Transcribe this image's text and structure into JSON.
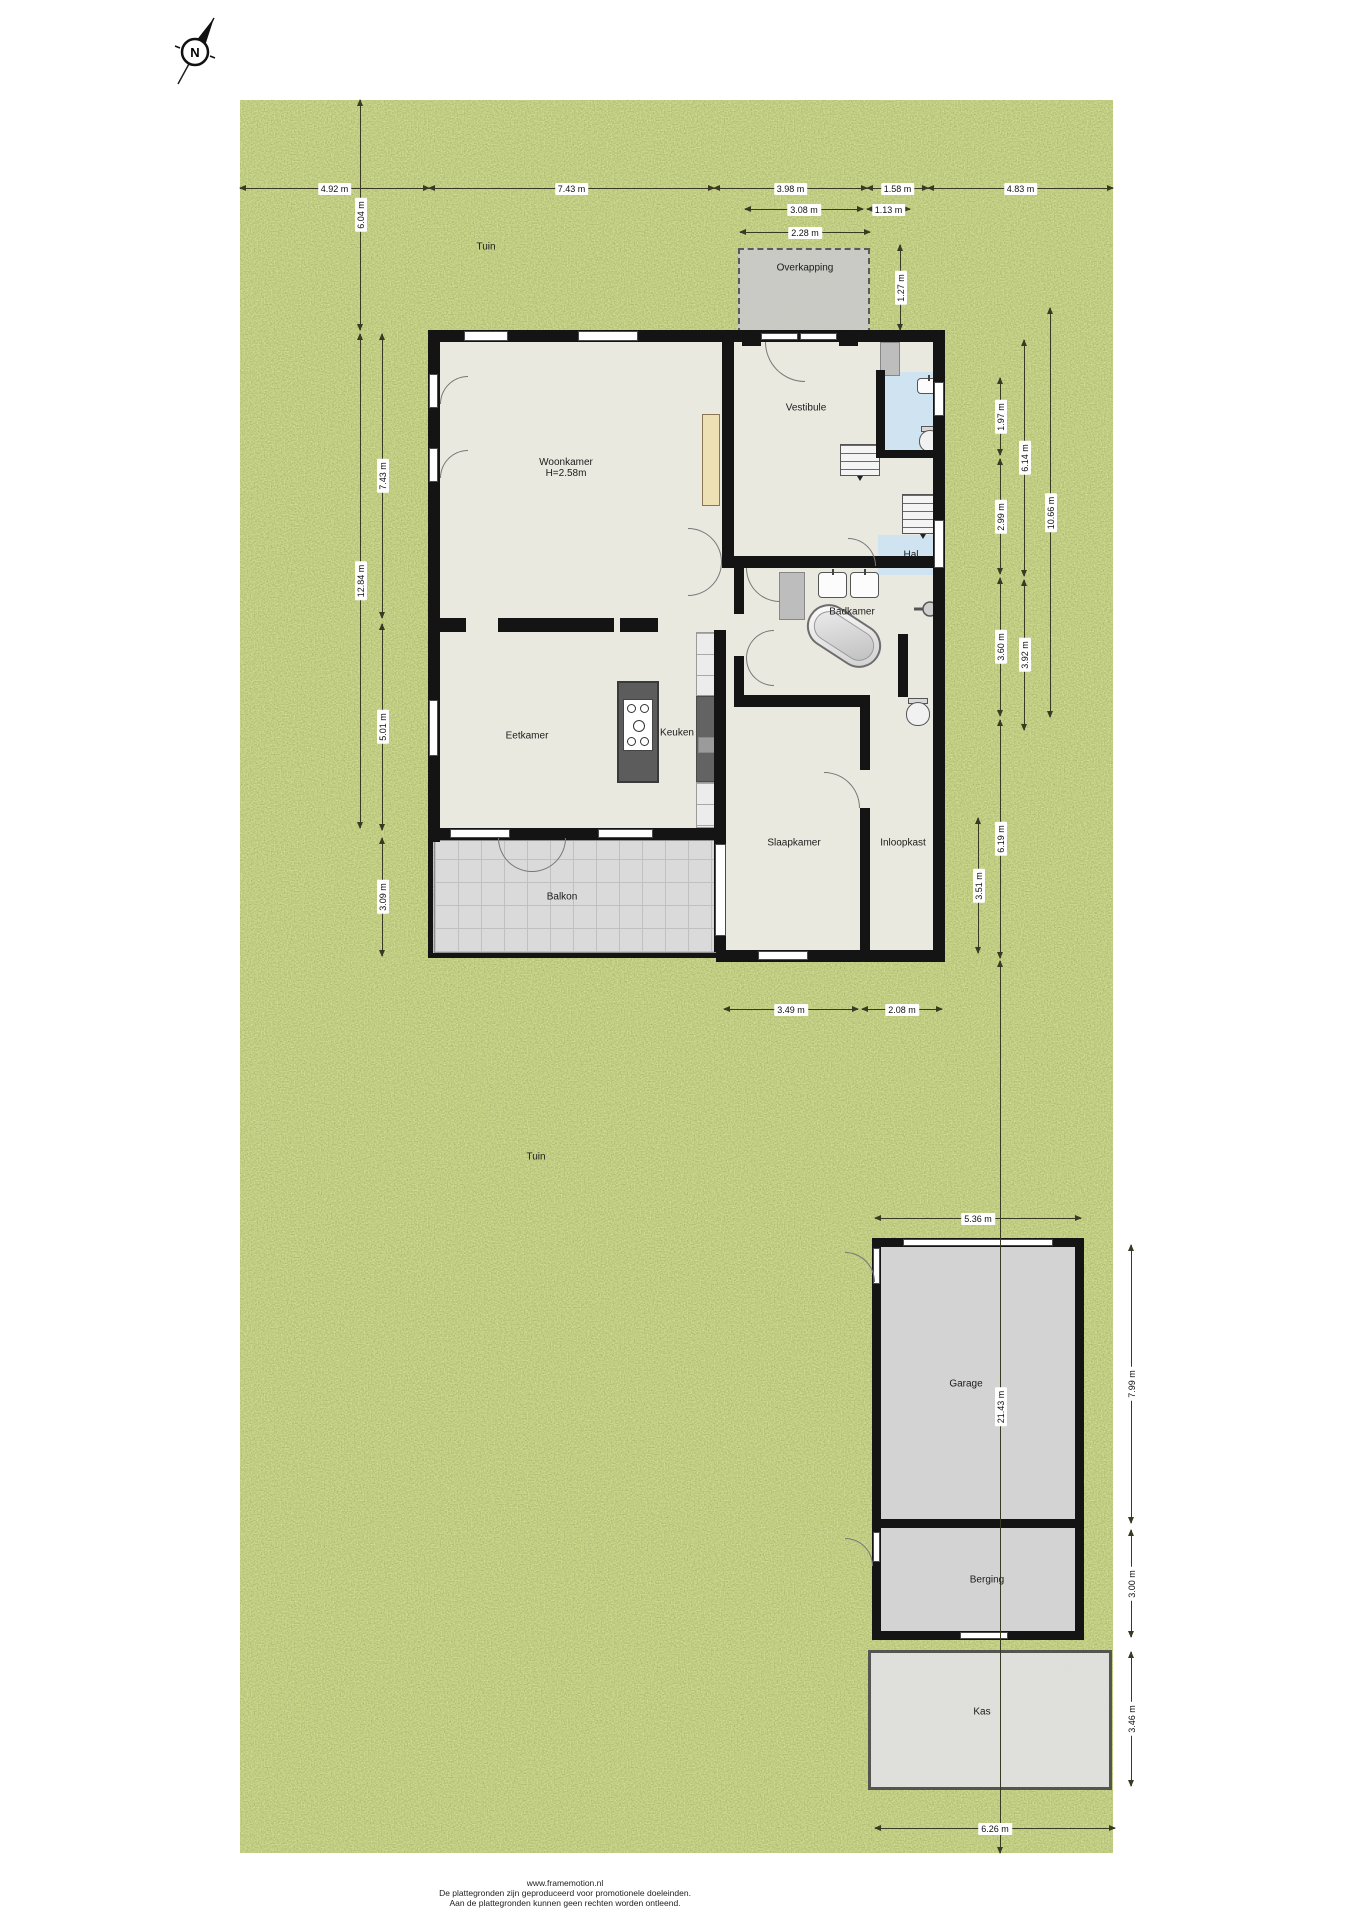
{
  "compass": {
    "label": "N"
  },
  "colors": {
    "garden": "#7b8b41",
    "floor": "#eae9e0",
    "wall": "#141414",
    "blue": "#cfe3f1",
    "balcony": "#dadada",
    "out": "#d3d3d3",
    "kas": "#e1e1e1",
    "dim": "#3a3a24",
    "label": "#1b1b1b"
  },
  "rooms": [
    {
      "id": "tuin-noord",
      "label": "Tuin",
      "x": 486,
      "y": 247
    },
    {
      "id": "overkapping",
      "label": "Overkapping",
      "x": 805,
      "y": 268
    },
    {
      "id": "woonkamer",
      "label": "Woonkamer",
      "sublabel": "H=2.58m",
      "x": 566,
      "y": 468
    },
    {
      "id": "vestibule",
      "label": "Vestibule",
      "x": 806,
      "y": 408
    },
    {
      "id": "hal",
      "label": "Hal",
      "x": 911,
      "y": 555
    },
    {
      "id": "badkamer",
      "label": "Badkamer",
      "x": 852,
      "y": 612
    },
    {
      "id": "eetkamer",
      "label": "Eetkamer",
      "x": 527,
      "y": 736
    },
    {
      "id": "keuken",
      "label": "Keuken",
      "x": 677,
      "y": 733
    },
    {
      "id": "slaapkamer",
      "label": "Slaapkamer",
      "x": 794,
      "y": 843
    },
    {
      "id": "inloopkast",
      "label": "Inloopkast",
      "x": 903,
      "y": 843
    },
    {
      "id": "balkon",
      "label": "Balkon",
      "x": 562,
      "y": 897
    },
    {
      "id": "tuin-zuid",
      "label": "Tuin",
      "x": 536,
      "y": 1157
    },
    {
      "id": "garage",
      "label": "Garage",
      "x": 966,
      "y": 1384
    },
    {
      "id": "berging",
      "label": "Berging",
      "x": 987,
      "y": 1580
    },
    {
      "id": "kas",
      "label": "Kas",
      "x": 982,
      "y": 1712
    }
  ],
  "dimensions": [
    {
      "text": "4.92 m",
      "orient": "h",
      "x1": 240,
      "x2": 429,
      "y": 188
    },
    {
      "text": "7.43 m",
      "orient": "h",
      "x1": 429,
      "x2": 714,
      "y": 188
    },
    {
      "text": "3.98 m",
      "orient": "h",
      "x1": 714,
      "x2": 867,
      "y": 188
    },
    {
      "text": "1.58 m",
      "orient": "h",
      "x1": 867,
      "x2": 928,
      "y": 188
    },
    {
      "text": "4.83 m",
      "orient": "h",
      "x1": 928,
      "x2": 1113,
      "y": 188
    },
    {
      "text": "3.08 m",
      "orient": "h",
      "x1": 745,
      "x2": 863,
      "y": 209
    },
    {
      "text": "1.13 m",
      "orient": "h",
      "x1": 867,
      "x2": 910,
      "y": 209
    },
    {
      "text": "2.28 m",
      "orient": "h",
      "x1": 740,
      "x2": 870,
      "y": 232
    },
    {
      "text": "1.27 m",
      "orient": "v",
      "x": 900,
      "y1": 245,
      "y2": 330
    },
    {
      "text": "6.04 m",
      "orient": "v",
      "x": 360,
      "y1": 100,
      "y2": 330
    },
    {
      "text": "12.84 m",
      "orient": "v",
      "x": 360,
      "y1": 334,
      "y2": 828
    },
    {
      "text": "7.43 m",
      "orient": "v",
      "x": 382,
      "y1": 334,
      "y2": 618
    },
    {
      "text": "5.01 m",
      "orient": "v",
      "x": 382,
      "y1": 624,
      "y2": 830
    },
    {
      "text": "3.09 m",
      "orient": "v",
      "x": 382,
      "y1": 838,
      "y2": 956
    },
    {
      "text": "1.97 m",
      "orient": "v",
      "x": 1000,
      "y1": 378,
      "y2": 455
    },
    {
      "text": "2.99 m",
      "orient": "v",
      "x": 1000,
      "y1": 459,
      "y2": 574
    },
    {
      "text": "3.60 m",
      "orient": "v",
      "x": 1000,
      "y1": 578,
      "y2": 716
    },
    {
      "text": "6.19 m",
      "orient": "v",
      "x": 1000,
      "y1": 720,
      "y2": 958
    },
    {
      "text": "6.14 m",
      "orient": "v",
      "x": 1024,
      "y1": 340,
      "y2": 576
    },
    {
      "text": "3.92 m",
      "orient": "v",
      "x": 1024,
      "y1": 580,
      "y2": 730
    },
    {
      "text": "10.66 m",
      "orient": "v",
      "x": 1050,
      "y1": 308,
      "y2": 717
    },
    {
      "text": "3.51 m",
      "orient": "v",
      "x": 978,
      "y1": 818,
      "y2": 953
    },
    {
      "text": "3.49 m",
      "orient": "h",
      "x1": 724,
      "x2": 858,
      "y": 1009
    },
    {
      "text": "2.08 m",
      "orient": "h",
      "x1": 862,
      "x2": 942,
      "y": 1009
    },
    {
      "text": "5.36 m",
      "orient": "h",
      "x1": 875,
      "x2": 1081,
      "y": 1218
    },
    {
      "text": "21.43 m",
      "orient": "v",
      "x": 1000,
      "y1": 961,
      "y2": 1853
    },
    {
      "text": "7.99 m",
      "orient": "v",
      "x": 1131,
      "y1": 1245,
      "y2": 1523
    },
    {
      "text": "3.00 m",
      "orient": "v",
      "x": 1131,
      "y1": 1530,
      "y2": 1637
    },
    {
      "text": "3.46 m",
      "orient": "v",
      "x": 1131,
      "y1": 1652,
      "y2": 1786
    },
    {
      "text": "6.26 m",
      "orient": "h",
      "x1": 875,
      "x2": 1115,
      "y": 1828
    }
  ],
  "footer": {
    "lines": [
      "www.framemotion.nl",
      "De plattegronden zijn geproduceerd voor promotionele doeleinden.",
      "Aan de plattegronden kunnen geen rechten worden ontleend."
    ]
  }
}
